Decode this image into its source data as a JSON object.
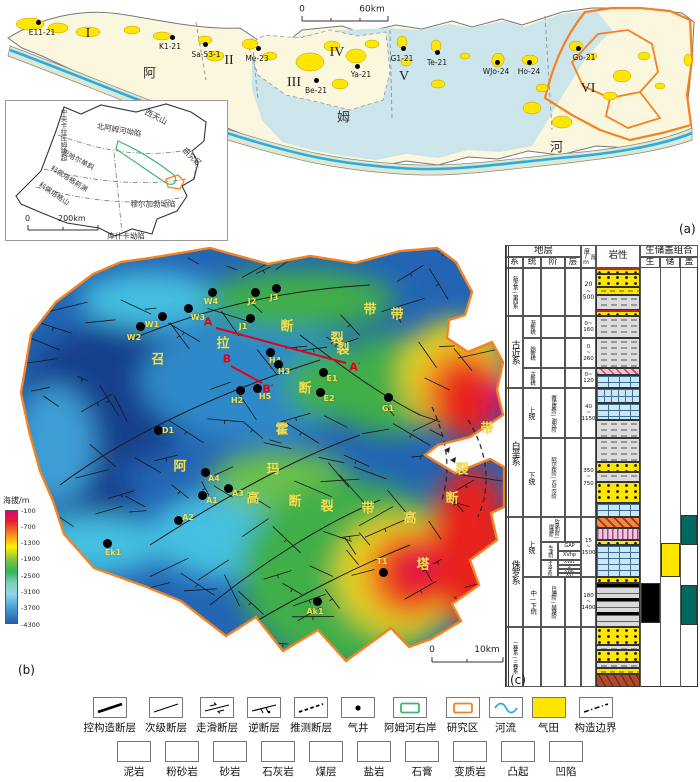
{
  "panels": {
    "a": "(a)",
    "b": "(b)",
    "c": "(c)"
  },
  "panel_a": {
    "scale": {
      "zero": "0",
      "end": "60km"
    },
    "river_name": [
      {
        "t": "阿",
        "x": 150,
        "y": 72
      },
      {
        "t": "姆",
        "x": 344,
        "y": 116
      },
      {
        "t": "河",
        "x": 557,
        "y": 146
      }
    ],
    "zones": [
      {
        "t": "I",
        "x": 88,
        "y": 34
      },
      {
        "t": "II",
        "x": 229,
        "y": 61
      },
      {
        "t": "III",
        "x": 294,
        "y": 83
      },
      {
        "t": "IV",
        "x": 337,
        "y": 53
      },
      {
        "t": "V",
        "x": 404,
        "y": 77
      },
      {
        "t": "VI",
        "x": 588,
        "y": 89
      }
    ],
    "wells": [
      {
        "n": "E11-21",
        "x": 38,
        "y": 22,
        "lx": 42,
        "ly": 28
      },
      {
        "n": "K1-21",
        "x": 172,
        "y": 37,
        "lx": 170,
        "ly": 42
      },
      {
        "n": "Sa-53-1",
        "x": 205,
        "y": 44,
        "lx": 206,
        "ly": 50
      },
      {
        "n": "Me-23",
        "x": 258,
        "y": 48,
        "lx": 257,
        "ly": 54
      },
      {
        "n": "Be-21",
        "x": 316,
        "y": 80,
        "lx": 316,
        "ly": 86
      },
      {
        "n": "Ya-21",
        "x": 357,
        "y": 66,
        "lx": 361,
        "ly": 70
      },
      {
        "n": "G1-21",
        "x": 403,
        "y": 48,
        "lx": 402,
        "ly": 54
      },
      {
        "n": "Te-21",
        "x": 437,
        "y": 52,
        "lx": 437,
        "ly": 58
      },
      {
        "n": "WJo-24",
        "x": 497,
        "y": 62,
        "lx": 496,
        "ly": 67
      },
      {
        "n": "Ho-24",
        "x": 529,
        "y": 62,
        "lx": 529,
        "ly": 67
      },
      {
        "n": "Go-21",
        "x": 578,
        "y": 48,
        "lx": 584,
        "ly": 53
      }
    ]
  },
  "inset": {
    "scale": {
      "zero": "0",
      "end": "200km"
    },
    "labels": [
      {
        "t": "西天山",
        "x": 150,
        "y": 16,
        "r": 27,
        "fs": 8
      },
      {
        "t": "中央卡拉库姆隆起",
        "x": 57,
        "y": 34,
        "v": 1,
        "fs": 6.5
      },
      {
        "t": "北阿姆河坳陷",
        "x": 113,
        "y": 29,
        "r": 10,
        "fs": 7.5
      },
      {
        "t": "研究区",
        "x": 186,
        "y": 56,
        "r": 42,
        "fs": 7.5
      },
      {
        "t": "巴哈尔单斜",
        "x": 72,
        "y": 59,
        "r": 28,
        "fs": 7
      },
      {
        "t": "科佩塔格前渊",
        "x": 63,
        "y": 78,
        "r": 32,
        "fs": 7
      },
      {
        "t": "科佩塔格山",
        "x": 48,
        "y": 93,
        "r": 34,
        "fs": 7
      },
      {
        "t": "穆尔加勃坳陷",
        "x": 147,
        "y": 103,
        "r": 0,
        "fs": 7.5
      },
      {
        "t": "库什卡坳陷",
        "x": 120,
        "y": 135,
        "r": 0,
        "fs": 7.5
      }
    ]
  },
  "panel_b": {
    "colorbar": {
      "title": "海拔/m",
      "ticks": [
        "-100",
        "-700",
        "-1300",
        "-1900",
        "-2500",
        "-3100",
        "-3700",
        "-4300"
      ]
    },
    "scale": {
      "zero": "0",
      "end": "10km"
    },
    "sections": [
      {
        "t": "A",
        "x": 208,
        "y": 77
      },
      {
        "t": "A′",
        "x": 355,
        "y": 122
      },
      {
        "t": "B",
        "x": 227,
        "y": 114
      },
      {
        "t": "B′",
        "x": 268,
        "y": 144
      }
    ],
    "wells": [
      {
        "n": "W2",
        "x": 140,
        "y": 81,
        "lx": 134,
        "ly": 88
      },
      {
        "n": "W1",
        "x": 162,
        "y": 71,
        "lx": 152,
        "ly": 75
      },
      {
        "n": "W3",
        "x": 188,
        "y": 63,
        "lx": 198,
        "ly": 68
      },
      {
        "n": "W4",
        "x": 212,
        "y": 47,
        "lx": 211,
        "ly": 52
      },
      {
        "n": "J2",
        "x": 255,
        "y": 47,
        "lx": 252,
        "ly": 52
      },
      {
        "n": "J3",
        "x": 276,
        "y": 43,
        "lx": 274,
        "ly": 48
      },
      {
        "n": "J1",
        "x": 250,
        "y": 73,
        "lx": 243,
        "ly": 77
      },
      {
        "n": "H4",
        "x": 270,
        "y": 107,
        "lx": 275,
        "ly": 111
      },
      {
        "n": "H3",
        "x": 278,
        "y": 119,
        "lx": 284,
        "ly": 122
      },
      {
        "n": "H2",
        "x": 240,
        "y": 145,
        "lx": 237,
        "ly": 151
      },
      {
        "n": "H5",
        "x": 257,
        "y": 143,
        "lx": 265,
        "ly": 147
      },
      {
        "n": "E1",
        "x": 323,
        "y": 127,
        "lx": 332,
        "ly": 129
      },
      {
        "n": "E2",
        "x": 320,
        "y": 147,
        "lx": 329,
        "ly": 149
      },
      {
        "n": "G1",
        "x": 388,
        "y": 152,
        "lx": 388,
        "ly": 159
      },
      {
        "n": "D1",
        "x": 158,
        "y": 185,
        "lx": 168,
        "ly": 181
      },
      {
        "n": "A4",
        "x": 205,
        "y": 227,
        "lx": 214,
        "ly": 229
      },
      {
        "n": "A1",
        "x": 202,
        "y": 250,
        "lx": 212,
        "ly": 251
      },
      {
        "n": "A3",
        "x": 228,
        "y": 243,
        "lx": 238,
        "ly": 244
      },
      {
        "n": "A2",
        "x": 178,
        "y": 275,
        "lx": 188,
        "ly": 268
      },
      {
        "n": "T1",
        "x": 383,
        "y": 327,
        "lx": 382,
        "ly": 312
      },
      {
        "n": "Ak1",
        "x": 317,
        "y": 356,
        "lx": 315,
        "ly": 362
      },
      {
        "n": "Ek1",
        "x": 107,
        "y": 298,
        "lx": 113,
        "ly": 303
      }
    ],
    "fault_chars": [
      {
        "t": "召",
        "x": 158,
        "y": 113
      },
      {
        "t": "拉",
        "x": 223,
        "y": 97
      },
      {
        "t": "断",
        "x": 287,
        "y": 80
      },
      {
        "t": "裂",
        "x": 337,
        "y": 92
      },
      {
        "t": "带",
        "x": 370,
        "y": 63
      },
      {
        "t": "带",
        "x": 397,
        "y": 68
      },
      {
        "t": "裂",
        "x": 343,
        "y": 103
      },
      {
        "t": "断",
        "x": 305,
        "y": 142
      },
      {
        "t": "霍",
        "x": 282,
        "y": 183
      },
      {
        "t": "阿",
        "x": 180,
        "y": 220
      },
      {
        "t": "玛",
        "x": 273,
        "y": 223
      },
      {
        "t": "高",
        "x": 253,
        "y": 252
      },
      {
        "t": "断",
        "x": 295,
        "y": 255
      },
      {
        "t": "裂",
        "x": 327,
        "y": 260
      },
      {
        "t": "带",
        "x": 368,
        "y": 262
      },
      {
        "t": "高",
        "x": 410,
        "y": 272
      },
      {
        "t": "塔",
        "x": 423,
        "y": 318
      },
      {
        "t": "带",
        "x": 487,
        "y": 182
      },
      {
        "t": "裂",
        "x": 462,
        "y": 223
      },
      {
        "t": "断",
        "x": 452,
        "y": 252
      }
    ]
  },
  "panel_c": {
    "cells": [
      {
        "t": "地层",
        "x": 506,
        "y": 245,
        "w": 75,
        "h": 12,
        "fs": 9.5
      },
      {
        "t": "厚度/m",
        "x": 581,
        "y": 245,
        "w": 15,
        "h": 23,
        "v": 1,
        "fs": 6
      },
      {
        "t": "岩性",
        "x": 596,
        "y": 245,
        "w": 44,
        "h": 23,
        "fs": 9.5
      },
      {
        "t": "生储盖组合",
        "x": 640,
        "y": 245,
        "w": 58,
        "h": 12,
        "fs": 9.5
      },
      {
        "t": "系",
        "x": 506,
        "y": 257,
        "w": 17,
        "h": 11,
        "fs": 8.5
      },
      {
        "t": "统",
        "x": 523,
        "y": 257,
        "w": 18,
        "h": 11,
        "fs": 8.5
      },
      {
        "t": "阶",
        "x": 541,
        "y": 257,
        "w": 24,
        "h": 11,
        "fs": 8.5
      },
      {
        "t": "层",
        "x": 565,
        "y": 257,
        "w": 16,
        "h": 11,
        "fs": 8.5
      },
      {
        "t": "生",
        "x": 640,
        "y": 257,
        "w": 20,
        "h": 11,
        "fs": 8.5
      },
      {
        "t": "储",
        "x": 660,
        "y": 257,
        "w": 20,
        "h": 11,
        "fs": 8.5
      },
      {
        "t": "盖",
        "x": 680,
        "y": 257,
        "w": 18,
        "h": 11,
        "fs": 8.5
      },
      {
        "t": "新近系—第四系",
        "x": 506,
        "y": 268,
        "w": 17,
        "h": 48,
        "v": 1,
        "fs": 5.5
      },
      {
        "t": "",
        "x": 523,
        "y": 268,
        "w": 18,
        "h": 48
      },
      {
        "t": "",
        "x": 541,
        "y": 268,
        "w": 24,
        "h": 48
      },
      {
        "t": "",
        "x": 565,
        "y": 268,
        "w": 16,
        "h": 48
      },
      {
        "t": "20\n~\n500",
        "x": 581,
        "y": 268,
        "w": 15,
        "h": 48,
        "fs": 6
      },
      {
        "t": "古近系",
        "x": 506,
        "y": 316,
        "w": 17,
        "h": 72,
        "v": 1,
        "fs": 9
      },
      {
        "t": "渐新统",
        "x": 523,
        "y": 316,
        "w": 18,
        "h": 22,
        "v": 1,
        "fs": 5.5
      },
      {
        "t": "",
        "x": 541,
        "y": 316,
        "w": 24,
        "h": 22
      },
      {
        "t": "",
        "x": 565,
        "y": 316,
        "w": 16,
        "h": 22
      },
      {
        "t": "0~\n160",
        "x": 581,
        "y": 316,
        "w": 15,
        "h": 22,
        "fs": 5.5
      },
      {
        "t": "始新统",
        "x": 523,
        "y": 338,
        "w": 18,
        "h": 30,
        "v": 1,
        "fs": 5.5
      },
      {
        "t": "",
        "x": 541,
        "y": 338,
        "w": 24,
        "h": 30
      },
      {
        "t": "",
        "x": 565,
        "y": 338,
        "w": 16,
        "h": 30
      },
      {
        "t": "0\n~\n260",
        "x": 581,
        "y": 338,
        "w": 15,
        "h": 30,
        "fs": 5.5
      },
      {
        "t": "古新统",
        "x": 523,
        "y": 368,
        "w": 18,
        "h": 20,
        "v": 1,
        "fs": 5.5
      },
      {
        "t": "",
        "x": 541,
        "y": 368,
        "w": 24,
        "h": 20
      },
      {
        "t": "",
        "x": 565,
        "y": 368,
        "w": 16,
        "h": 20
      },
      {
        "t": "0~\n120",
        "x": 581,
        "y": 368,
        "w": 15,
        "h": 20,
        "fs": 5.5
      },
      {
        "t": "白垩系",
        "x": 506,
        "y": 388,
        "w": 17,
        "h": 129,
        "v": 1,
        "fs": 9
      },
      {
        "t": "上统",
        "x": 523,
        "y": 388,
        "w": 18,
        "h": 50,
        "v": 1,
        "fs": 7
      },
      {
        "t": "赛诺曼阶—谢农阶",
        "x": 541,
        "y": 388,
        "w": 24,
        "h": 50,
        "v": 1,
        "fs": 5.5
      },
      {
        "t": "",
        "x": 565,
        "y": 388,
        "w": 16,
        "h": 50
      },
      {
        "t": "40\n~\n1150",
        "x": 581,
        "y": 388,
        "w": 15,
        "h": 50,
        "fs": 5.5
      },
      {
        "t": "下统",
        "x": 523,
        "y": 438,
        "w": 18,
        "h": 79,
        "v": 1,
        "fs": 7
      },
      {
        "t": "阿尔布阶—瓦兰今阶",
        "x": 541,
        "y": 438,
        "w": 24,
        "h": 79,
        "v": 1,
        "fs": 5.5
      },
      {
        "t": "",
        "x": 565,
        "y": 438,
        "w": 16,
        "h": 79
      },
      {
        "t": "350\n~\n750",
        "x": 581,
        "y": 438,
        "w": 15,
        "h": 79,
        "fs": 5.5
      },
      {
        "t": "侏罗系",
        "x": 506,
        "y": 517,
        "w": 17,
        "h": 110,
        "v": 1,
        "fs": 9
      },
      {
        "t": "上统",
        "x": 523,
        "y": 517,
        "w": 18,
        "h": 60,
        "v": 1,
        "fs": 7
      },
      {
        "t": "钦莫利阶—提塘阶",
        "x": 541,
        "y": 517,
        "w": 24,
        "h": 25,
        "v": 1,
        "fs": 5
      },
      {
        "t": "",
        "x": 565,
        "y": 517,
        "w": 16,
        "h": 25
      },
      {
        "t": "15\n~\n1500",
        "x": 581,
        "y": 517,
        "w": 15,
        "h": 60,
        "fs": 5.5
      },
      {
        "t": "牛津阶",
        "x": 541,
        "y": 542,
        "w": 17,
        "h": 18,
        "v": 1,
        "fs": 5
      },
      {
        "t": "GAP",
        "x": 558,
        "y": 542,
        "w": 23,
        "h": 9,
        "fs": 5
      },
      {
        "t": "XVhp",
        "x": 558,
        "y": 551,
        "w": 23,
        "h": 9,
        "fs": 5
      },
      {
        "t": "卡洛夫阶",
        "x": 541,
        "y": 560,
        "w": 17,
        "h": 17,
        "v": 1,
        "fs": 4.6
      },
      {
        "t": "XVa1",
        "x": 558,
        "y": 560,
        "w": 23,
        "h": 5,
        "fs": 4.2
      },
      {
        "t": "Z",
        "x": 558,
        "y": 565,
        "w": 23,
        "h": 4,
        "fs": 4.2
      },
      {
        "t": "XVac",
        "x": 558,
        "y": 569,
        "w": 23,
        "h": 4,
        "fs": 4.2
      },
      {
        "t": "XVI",
        "x": 558,
        "y": 573,
        "w": 23,
        "h": 4,
        "fs": 4.2
      },
      {
        "t": "中—下统",
        "x": 523,
        "y": 577,
        "w": 18,
        "h": 50,
        "v": 1,
        "fs": 6.5
      },
      {
        "t": "巴通阶—赫塘阶",
        "x": 541,
        "y": 577,
        "w": 24,
        "h": 50,
        "v": 1,
        "fs": 5.5
      },
      {
        "t": "",
        "x": 565,
        "y": 577,
        "w": 16,
        "h": 50
      },
      {
        "t": "180\n~\n1400",
        "x": 581,
        "y": 577,
        "w": 15,
        "h": 50,
        "fs": 5.5
      },
      {
        "t": "二叠系—三叠系",
        "x": 506,
        "y": 627,
        "w": 17,
        "h": 60,
        "v": 1,
        "fs": 5.5
      },
      {
        "t": "",
        "x": 523,
        "y": 627,
        "w": 18,
        "h": 60
      },
      {
        "t": "",
        "x": 541,
        "y": 627,
        "w": 24,
        "h": 60
      },
      {
        "t": "",
        "x": 565,
        "y": 627,
        "w": 16,
        "h": 60
      },
      {
        "t": "",
        "x": 581,
        "y": 627,
        "w": 15,
        "h": 60
      }
    ],
    "litho": [
      {
        "y": 268,
        "h": 6,
        "p": "wave"
      },
      {
        "y": 274,
        "h": 13,
        "p": "sand"
      },
      {
        "y": 287,
        "h": 8,
        "p": "silt"
      },
      {
        "y": 295,
        "h": 15,
        "p": "mud"
      },
      {
        "y": 310,
        "h": 6,
        "p": "wave"
      },
      {
        "y": 316,
        "h": 22,
        "p": "mud"
      },
      {
        "y": 338,
        "h": 30,
        "p": "mud"
      },
      {
        "y": 368,
        "h": 7,
        "p": "gyph"
      },
      {
        "y": 375,
        "h": 13,
        "p": "lime"
      },
      {
        "y": 388,
        "h": 15,
        "p": "marl"
      },
      {
        "y": 403,
        "h": 17,
        "p": "lime"
      },
      {
        "y": 420,
        "h": 18,
        "p": "mud"
      },
      {
        "y": 438,
        "h": 24,
        "p": "mud"
      },
      {
        "y": 462,
        "h": 10,
        "p": "sand"
      },
      {
        "y": 472,
        "h": 10,
        "p": "mud"
      },
      {
        "y": 482,
        "h": 21,
        "p": "sand"
      },
      {
        "y": 503,
        "h": 14,
        "p": "lime"
      },
      {
        "y": 517,
        "h": 11,
        "p": "salt"
      },
      {
        "y": 528,
        "h": 12,
        "p": "gyp"
      },
      {
        "y": 540,
        "h": 5,
        "p": "sand"
      },
      {
        "y": 545,
        "h": 32,
        "p": "lime"
      },
      {
        "y": 577,
        "h": 6,
        "p": "sand"
      },
      {
        "y": 583,
        "h": 44,
        "p": "coal"
      },
      {
        "y": 627,
        "h": 18,
        "p": "sand"
      },
      {
        "y": 645,
        "h": 5,
        "p": "mud"
      },
      {
        "y": 650,
        "h": 12,
        "p": "sand"
      },
      {
        "y": 662,
        "h": 6,
        "p": "mud"
      },
      {
        "y": 668,
        "h": 6,
        "p": "silt"
      },
      {
        "y": 674,
        "h": 13,
        "p": "meta"
      }
    ],
    "combo": [
      {
        "x": 641,
        "y": 583,
        "w": 19,
        "h": 40,
        "c": "#000000"
      },
      {
        "x": 661,
        "y": 543,
        "w": 19,
        "h": 34,
        "c": "#FFE600"
      },
      {
        "x": 681,
        "y": 515,
        "w": 16,
        "h": 30,
        "c": "#00695F"
      },
      {
        "x": 681,
        "y": 585,
        "w": 16,
        "h": 40,
        "c": "#00695F"
      }
    ]
  },
  "legend_row1": [
    {
      "label": "控构造断层",
      "glyph": "thick-line"
    },
    {
      "label": "次级断层",
      "glyph": "thin-line"
    },
    {
      "label": "走滑断层",
      "glyph": "strike-slip"
    },
    {
      "label": "逆断层",
      "glyph": "reverse-fault"
    },
    {
      "label": "推测断层",
      "glyph": "inferred-fault"
    },
    {
      "label": "气井",
      "glyph": "gas-well"
    },
    {
      "label": "阿姆河右岸",
      "glyph": "green-outline"
    },
    {
      "label": "研究区",
      "glyph": "orange-outline"
    },
    {
      "label": "河流",
      "glyph": "river"
    },
    {
      "label": "气田",
      "glyph": "gas-field"
    },
    {
      "label": "构造边界",
      "glyph": "structure-boundary"
    }
  ],
  "legend_row2": [
    {
      "label": "泥岩",
      "glyph": "mud"
    },
    {
      "label": "粉砂岩",
      "glyph": "silt"
    },
    {
      "label": "砂岩",
      "glyph": "sand"
    },
    {
      "label": "石灰岩",
      "glyph": "lime"
    },
    {
      "label": "煤层",
      "glyph": "coal"
    },
    {
      "label": "盐岩",
      "glyph": "salt"
    },
    {
      "label": "石膏",
      "glyph": "gyp"
    },
    {
      "label": "变质岩",
      "glyph": "meta"
    },
    {
      "label": "凸起",
      "glyph": "upl"
    },
    {
      "label": "凹陷",
      "glyph": "dep"
    }
  ],
  "colors": {
    "gas_field": "#FFE600",
    "research_outline": "#F58220",
    "right_bank_outline": "#3AB86C",
    "river": "#2AACE2",
    "section_line": "#E60012",
    "map_label": "#F2DE4E",
    "seal_block": "#00695F",
    "uplift_fill": "#FBF7DE",
    "depression_fill": "#CBE5EB"
  }
}
